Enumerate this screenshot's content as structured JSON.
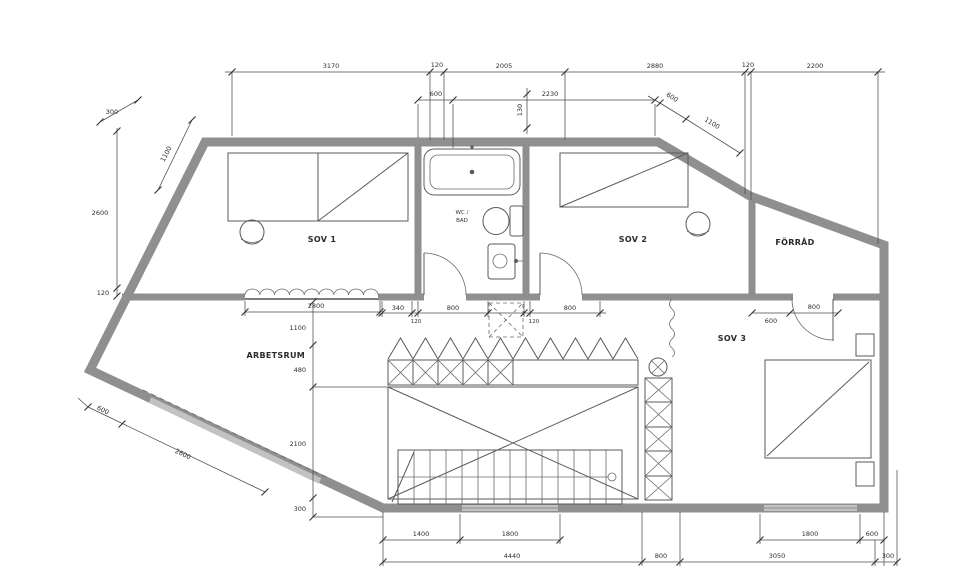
{
  "drawing": {
    "type": "architectural floor plan",
    "rooms": {
      "sov1": "SOV 1",
      "sov2": "SOV 2",
      "sov3": "SOV 3",
      "forrad": "FÖRRÅD",
      "arbetsrum": "ARBETSRUM",
      "wc_line1": "WC /",
      "wc_line2": "BAD"
    },
    "dims": {
      "top": [
        "3170",
        "120",
        "2005",
        "2880",
        "120",
        "2200"
      ],
      "bath": [
        "600",
        "2230",
        "130"
      ],
      "topright": [
        "600",
        "1100"
      ],
      "left": [
        "300",
        "1100",
        "2600",
        "120"
      ],
      "window": [
        "2800"
      ],
      "mid": [
        "340",
        "800",
        "120",
        "120",
        "800"
      ],
      "door3": [
        "600",
        "800"
      ],
      "col": [
        "1100",
        "480",
        "2100",
        "300"
      ],
      "bottomleft": [
        "600",
        "2600"
      ],
      "row1": [
        "1400",
        "1800",
        "1800",
        "600"
      ],
      "row2": [
        "4440",
        "800",
        "3050",
        "300"
      ]
    },
    "symbols": {
      "bathtub": "bathtub-icon",
      "toilet": "toilet-icon",
      "sink": "sink-icon",
      "bed": "bed-with-diagonal-icon",
      "wardrobe": "wardrobe-icon",
      "chair": "round-chair-icon",
      "stairs": "staircase-icon",
      "void": "open-to-below-cross",
      "railing": "x-braced-railing",
      "column": "circle-cross-column-icon",
      "shaft": "dashed-shaft-cross"
    },
    "colors": {
      "wall": "#8f8f8f",
      "line": "#5a5a5a",
      "dimension": "#4a4a4a",
      "background": "#ffffff",
      "window_band": "#c2c2c2"
    }
  }
}
